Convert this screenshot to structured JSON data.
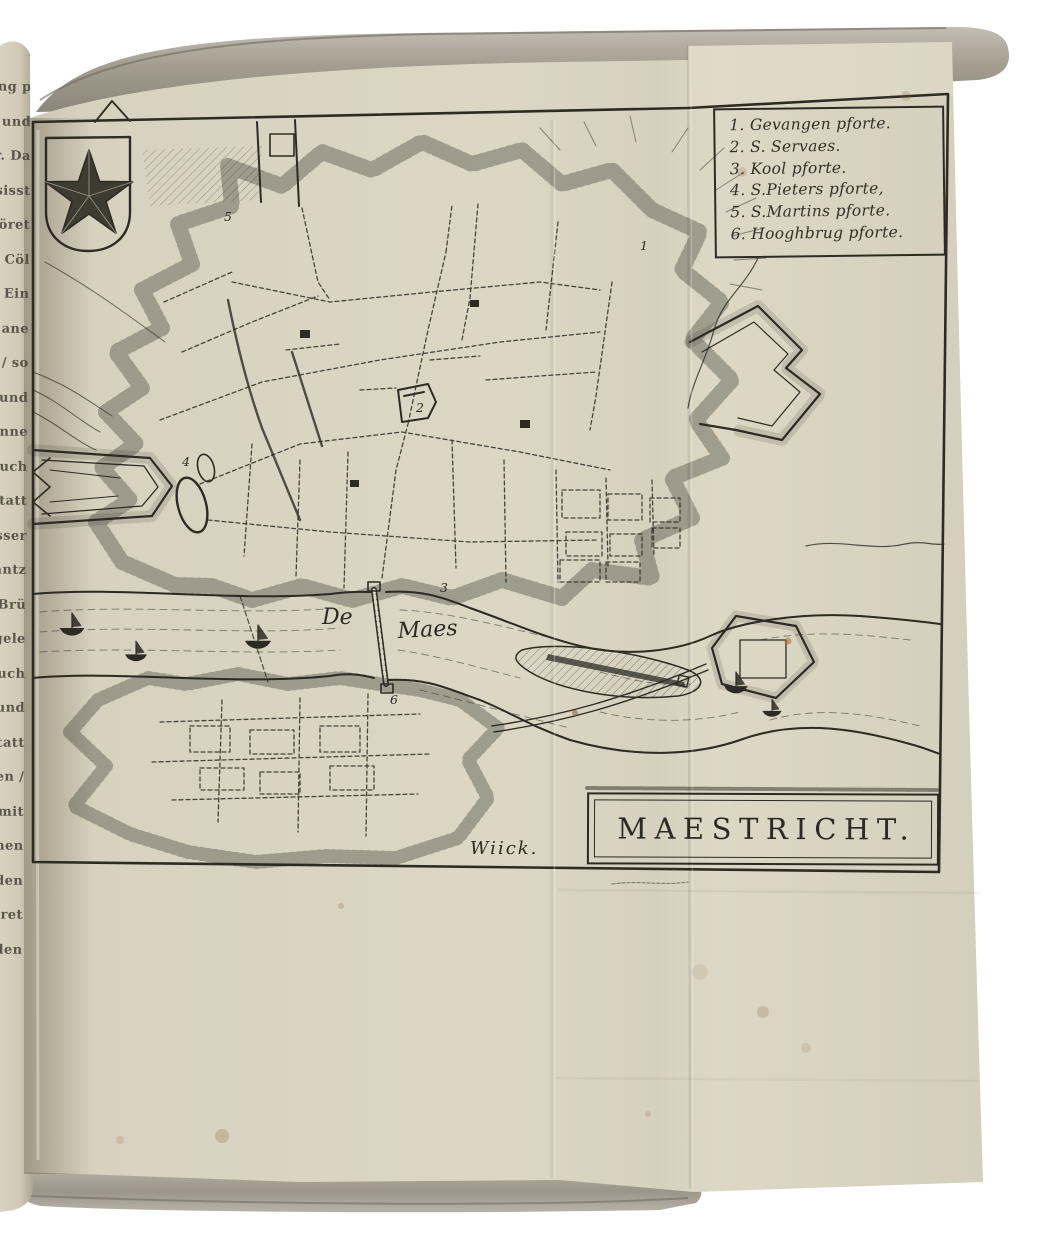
{
  "scene": {
    "description": "Antique book opened to an engraved folding plate: fortification plan of Maastricht",
    "background_color": "#ffffff"
  },
  "colors": {
    "paper": "#dad5c3",
    "ink": "#2e2b24",
    "book_edge_gray": "#a29d8f",
    "foxing_brown": "#8a6a3e"
  },
  "book": {
    "marginalia_text": "chung p\nrechen: und\nst Geur. Da\nvan Ersisst\nEs gehöret\ner nach Cöl\nDas Ein\ntopien / ane\nliesen / so\nden sie und\naschen anne\ngen / auch\nder Statt\nzu wasser\nden gantz\nen die Brü\ncken gele\nals auch\nWasser und\ndie Statt\ngelegen /\nund mit\nschönen\nGebäuden\ngezieret\nworden"
  },
  "map": {
    "legend": {
      "items": [
        "1. Gevangen pforte.",
        "2. S. Servaes.",
        "3. Kool  pforte.",
        "4. S.Pieters pforte,",
        "5. S.Martins pforte.",
        "6. Hooghbrug pforte."
      ]
    },
    "labels": {
      "river_word1": "De",
      "river_word2": "Maes",
      "district": "Wiick.",
      "title": "MAESTRICHT."
    },
    "markers": [
      "1",
      "2",
      "3",
      "4",
      "5",
      "6"
    ],
    "icons": {
      "shield": "star-shield",
      "boat": "sailboat",
      "bridge": "maas-bridge",
      "church": "church-building"
    }
  }
}
